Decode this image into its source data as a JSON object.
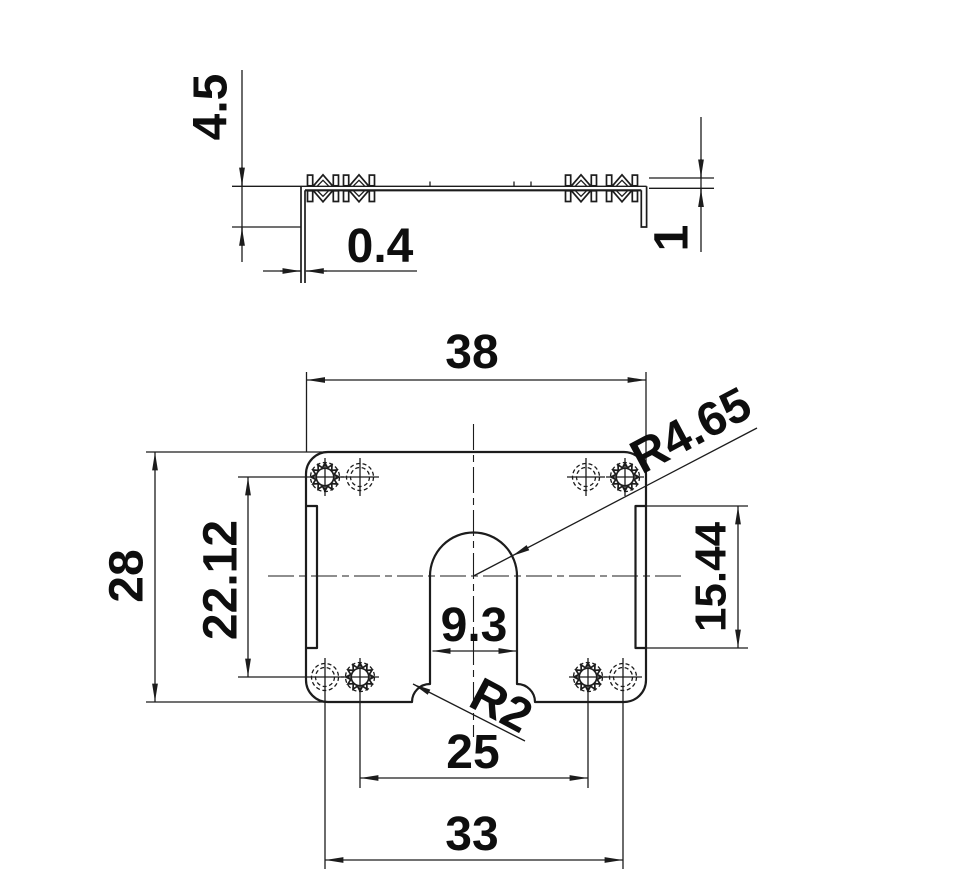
{
  "drawing": {
    "type": "engineering-dimension-drawing",
    "side_view": {
      "dims": {
        "flange_length": "4.5",
        "material_thickness": "0.4",
        "tab_height": "1"
      }
    },
    "plan_view": {
      "dims": {
        "overall_width": "38",
        "overall_height": "28",
        "hole_row_spacing": "22.12",
        "edge_slot_length": "15.44",
        "slot_width": "9.3",
        "slot_dome_radius": "R4.65",
        "slot_mouth_radius": "R2",
        "inner_hole_spacing": "25",
        "outer_hole_spacing": "33"
      }
    },
    "colors": {
      "line": "#1c1c1c",
      "text": "#0e0e0e",
      "background": "#ffffff"
    }
  }
}
